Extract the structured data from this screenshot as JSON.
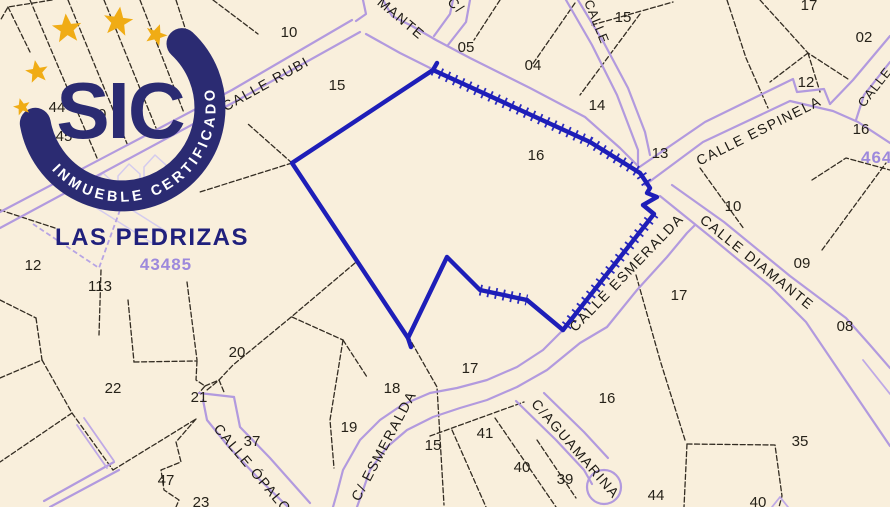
{
  "badge": {
    "acronym": "SIC",
    "ring_text": "INMUEBLE CERTIFICADO",
    "navy": "#2b2b72",
    "gold": "#f0ac15"
  },
  "map": {
    "area_label": "LAS PEDRIZAS",
    "cadastral_refs": [
      {
        "value": "43485"
      },
      {
        "value": "464"
      }
    ],
    "streets": [
      {
        "label": "CALLE RUBI"
      },
      {
        "label": "MANTE"
      },
      {
        "label": "C/"
      },
      {
        "label": "CALLE"
      },
      {
        "label": "CALLE ESPINELA"
      },
      {
        "label": "CALLE"
      },
      {
        "label": "CALLE ESMERALDA"
      },
      {
        "label": "CALLE DIAMANTE"
      },
      {
        "label": "C/ ESMERALDA"
      },
      {
        "label": "C/AGUAMARINA"
      },
      {
        "label": "CALLE ÓPALO"
      }
    ],
    "parcel_numbers": [
      {
        "value": "15"
      },
      {
        "value": "05"
      },
      {
        "value": "04"
      },
      {
        "value": "14"
      },
      {
        "value": "16"
      },
      {
        "value": "13"
      },
      {
        "value": "15"
      },
      {
        "value": "17"
      },
      {
        "value": "02"
      },
      {
        "value": "12"
      },
      {
        "value": "16"
      },
      {
        "value": "10"
      },
      {
        "value": "09"
      },
      {
        "value": "17"
      },
      {
        "value": "08"
      },
      {
        "value": "10"
      },
      {
        "value": "44"
      },
      {
        "value": "40"
      },
      {
        "value": "45"
      },
      {
        "value": "1"
      },
      {
        "value": "12"
      },
      {
        "value": "113"
      },
      {
        "value": "20"
      },
      {
        "value": "22"
      },
      {
        "value": "21"
      },
      {
        "value": "37"
      },
      {
        "value": "47"
      },
      {
        "value": "23"
      },
      {
        "value": "19"
      },
      {
        "value": "18"
      },
      {
        "value": "17"
      },
      {
        "value": "15"
      },
      {
        "value": "41"
      },
      {
        "value": "40"
      },
      {
        "value": "39"
      },
      {
        "value": "16"
      },
      {
        "value": "44"
      },
      {
        "value": "35"
      },
      {
        "value": "40"
      }
    ]
  }
}
